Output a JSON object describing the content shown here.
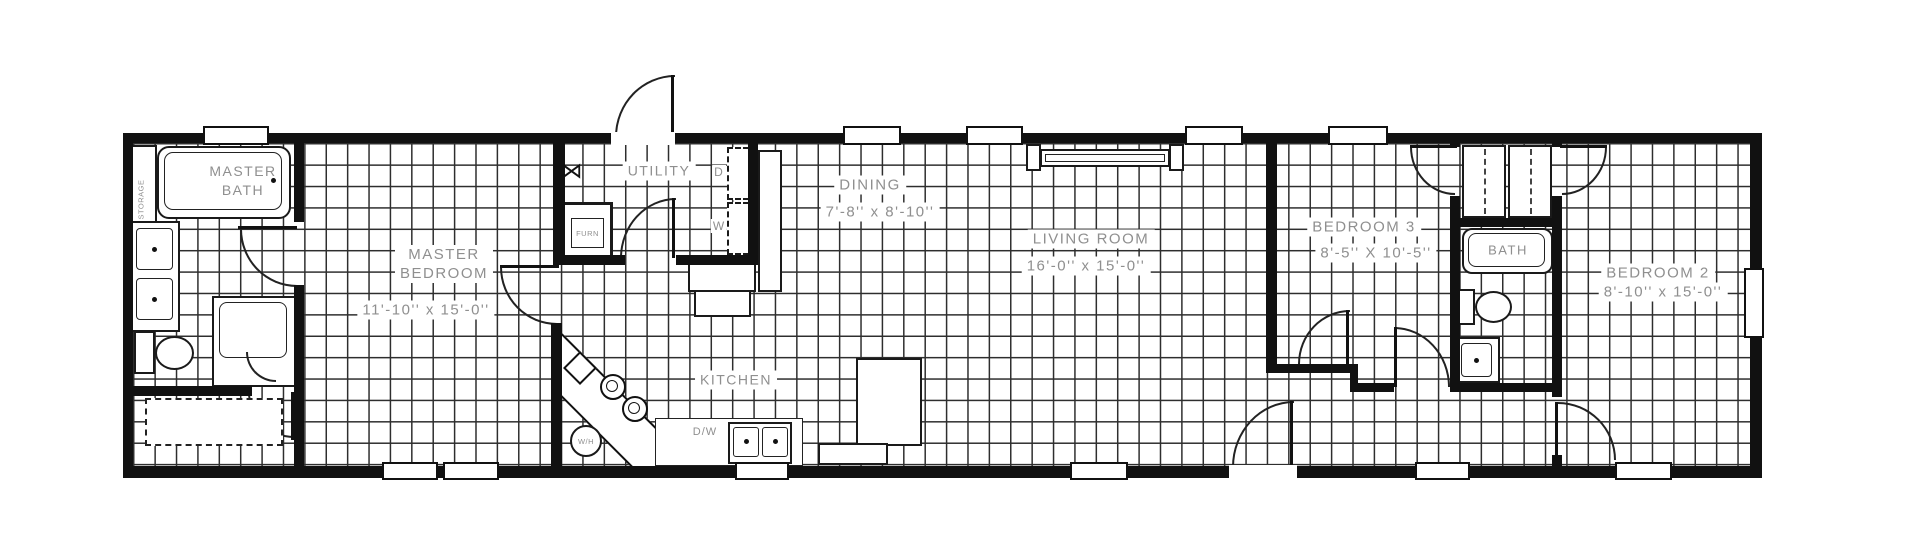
{
  "plan": {
    "type": "single-wide-home-floor-plan",
    "rooms": {
      "master_bath": {
        "name1": "MASTER",
        "name2": "BATH"
      },
      "master_bedroom": {
        "name1": "MASTER",
        "name2": "BEDROOM",
        "dims": "11'-10'' x 15'-0''"
      },
      "utility": {
        "name": "UTILITY"
      },
      "dining": {
        "name": "DINING",
        "dims": "7'-8'' x 8'-10''"
      },
      "kitchen": {
        "name": "KITCHEN"
      },
      "living_room": {
        "name": "LIVING ROOM",
        "dims": "16'-0'' x 15'-0''"
      },
      "bedroom_3": {
        "name": "BEDROOM 3",
        "dims": "8'-5'' X 10'-5''"
      },
      "bath": {
        "name": "BATH"
      },
      "bedroom_2": {
        "name": "BEDROOM 2",
        "dims": "8'-10'' x 15'-0''"
      }
    },
    "fixtures": {
      "dryer": "D",
      "washer": "W",
      "furnace": "FURN",
      "water_heater": "W/H",
      "dishwasher": "D/W",
      "storage": "STORAGE",
      "shelf_icon": "⋈"
    },
    "colors": {
      "wall": "#111111",
      "grid_line": "#2e2e2e",
      "label": "#8f8f8f",
      "floor": "#ffffff"
    }
  }
}
